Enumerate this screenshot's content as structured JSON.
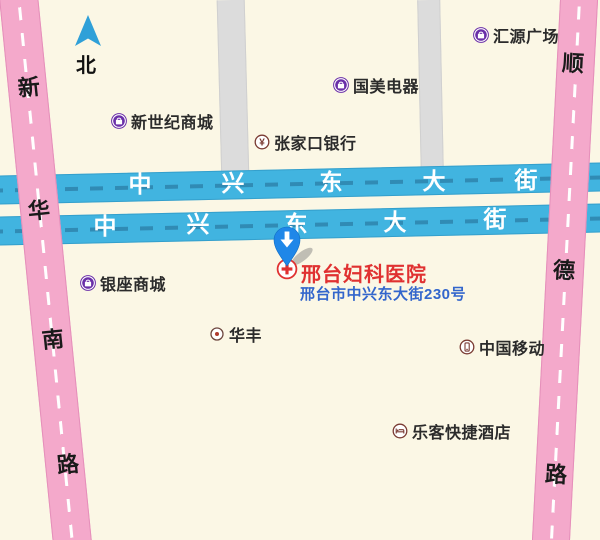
{
  "map": {
    "compass": {
      "label": "北"
    },
    "roads": {
      "zhongxing_upper": {
        "name": "中兴东大街",
        "chars": [
          "中",
          "兴",
          "东",
          "大",
          "街"
        ],
        "color": "#41b4e0"
      },
      "zhongxing_lower": {
        "name": "中兴东大街",
        "chars": [
          "中",
          "兴",
          "东",
          "大",
          "街"
        ],
        "color": "#41b4e0"
      },
      "xinhuanan": {
        "name": "新华南路",
        "chars": [
          "新",
          "华",
          "南",
          "路"
        ],
        "color": "#f4a9cb"
      },
      "shunde": {
        "name": "顺德路",
        "chars": [
          "顺",
          "德",
          "路"
        ],
        "color": "#f4a9cb"
      }
    },
    "pois": [
      {
        "label": "汇源广场",
        "icon": "shopping-bag-icon"
      },
      {
        "label": "国美电器",
        "icon": "shopping-bag-icon"
      },
      {
        "label": "新世纪商城",
        "icon": "shopping-bag-icon"
      },
      {
        "label": "张家口银行",
        "icon": "bank-yuan-icon"
      },
      {
        "label": "银座商城",
        "icon": "shopping-bag-icon"
      },
      {
        "label": "华丰",
        "icon": "dot-icon"
      },
      {
        "label": "中国移动",
        "icon": "mobile-phone-icon"
      },
      {
        "label": "乐客快捷酒店",
        "icon": "bed-icon"
      }
    ],
    "destination": {
      "name": "邢台妇科医院",
      "address": "邢台市中兴东大街230号",
      "name_color": "#e03131",
      "address_color": "#3366cc",
      "pin_color": "#1f87e8"
    },
    "colors": {
      "background": "#fbf7e5",
      "road_blue": "#41b4e0",
      "road_pink": "#f4a9cb",
      "road_gray": "#dcdcdc",
      "poi_purple": "#6a2fa8",
      "poi_maroon": "#7a3b33"
    }
  }
}
